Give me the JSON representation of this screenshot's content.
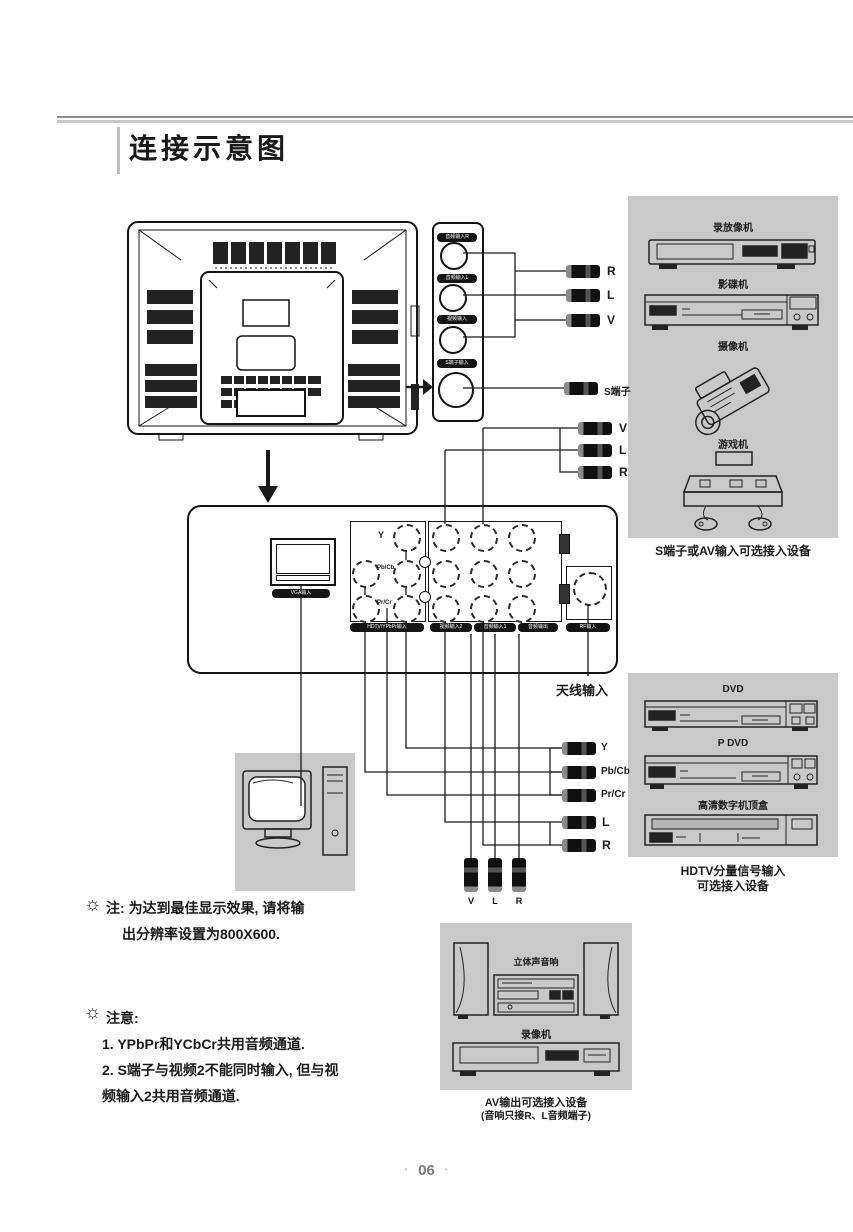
{
  "title": "连接示意图",
  "footer": {
    "page": "06",
    "dot": "·"
  },
  "strip": {
    "jack1": "音频输入R",
    "jack2": "音频输入L",
    "jack3": "视频输入",
    "jack4": "S端子输入"
  },
  "cables": {
    "a": [
      "R",
      "L",
      "V"
    ],
    "s": "S端子",
    "b": [
      "V",
      "L",
      "R"
    ],
    "c": [
      "Y",
      "Pb/Cb",
      "Pr/Cr"
    ],
    "d": [
      "L",
      "R"
    ],
    "e": [
      "V",
      "L",
      "R"
    ]
  },
  "panel_jacks": {
    "vga": "VGA输入",
    "hdtv_y": "Y",
    "hdtv_pb": "Pb/Cb",
    "hdtv_pr": "Pr/Cr",
    "hdtv_caption": "HDTV/YPbPr输入",
    "video_in": "视频输入2",
    "audio_in": "音频输入1",
    "audio_out": "音频输出",
    "rf": "RF输入",
    "antenna": "天线输入"
  },
  "panels": {
    "s_av": {
      "devices": [
        "录放像机",
        "影碟机",
        "摄像机",
        "游戏机"
      ],
      "caption": "S端子或AV输入可选接入设备"
    },
    "hdtv": {
      "devices": [
        "DVD",
        "P DVD",
        "高清数字机顶盒"
      ],
      "caption1": "HDTV分量信号输入",
      "caption2": "可选接入设备"
    },
    "av_out": {
      "devices": [
        "立体声音响",
        "录像机"
      ],
      "caption1": "AV输出可选接入设备",
      "caption2": "(音响只接R、L音频端子)"
    }
  },
  "notes": {
    "icon": "☼",
    "n1_label": "注:",
    "n1_line1": "为达到最佳显示效果, 请将输",
    "n1_line2": "出分辨率设置为800X600.",
    "n2_label": "注意:",
    "n2_item1": "1. YPbPr和YCbCr共用音频通道.",
    "n2_item2": "2. S端子与视频2不能同时输入, 但与视",
    "n2_item3": "频输入2共用音频通道."
  }
}
